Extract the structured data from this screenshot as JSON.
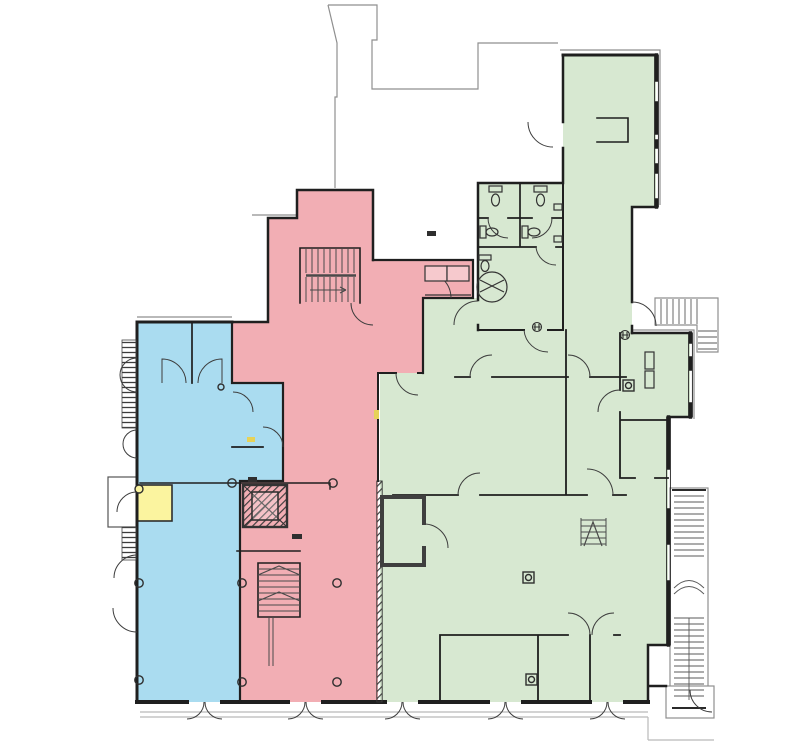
{
  "document": {
    "kind": "architectural-floor-plan",
    "description": "Ground floor plan with four colour-highlighted demise zones, stairs, lift core, WC cluster and entrance doors",
    "visible_text": []
  },
  "palette": {
    "background": "#ffffff",
    "wall": "#1f1f1f",
    "partition": "#2d2d2d",
    "outline_gray": "#8f8f8f",
    "sidewalk_gray": "#b9b9b9",
    "door": "#3d3d3d",
    "stair": "#4a4a4a",
    "fixture": "#333333",
    "zone_blue": "#aadcf0",
    "zone_pink": "#f2aeb4",
    "zone_green": "#d7e8d1",
    "zone_yellow": "#fbf49f",
    "cabinet_pink": "#f6c9cd",
    "hatch_dark": "#3f3f3f",
    "tag_dark": "#2f2f2f",
    "tag_yellow": "#e6d258",
    "white": "#ffffff"
  },
  "zones": [
    {
      "id": "zone-west-blue",
      "role": "west retail unit",
      "color": "#aadcf0"
    },
    {
      "id": "zone-core-pink",
      "role": "central core unit with stairs and lift",
      "color": "#f2aeb4"
    },
    {
      "id": "zone-east-green",
      "role": "large east unit with WC cluster",
      "color": "#d7e8d1"
    },
    {
      "id": "zone-highlight-yellow",
      "role": "small highlighted room on west wall",
      "color": "#fbf49f"
    }
  ],
  "features": {
    "lift": "hatched elevator shaft in pink core",
    "stairs": [
      "core switchback stair (top)",
      "core lower stair",
      "small internal step stair",
      "external long escape stair (east edge)",
      "external L-stair (north-east)"
    ],
    "wcs": "WC cluster with five toilets and accessible turning circle",
    "entrances": "five double-leaf entrance doors along south wall, one vestibule exit south-east"
  }
}
